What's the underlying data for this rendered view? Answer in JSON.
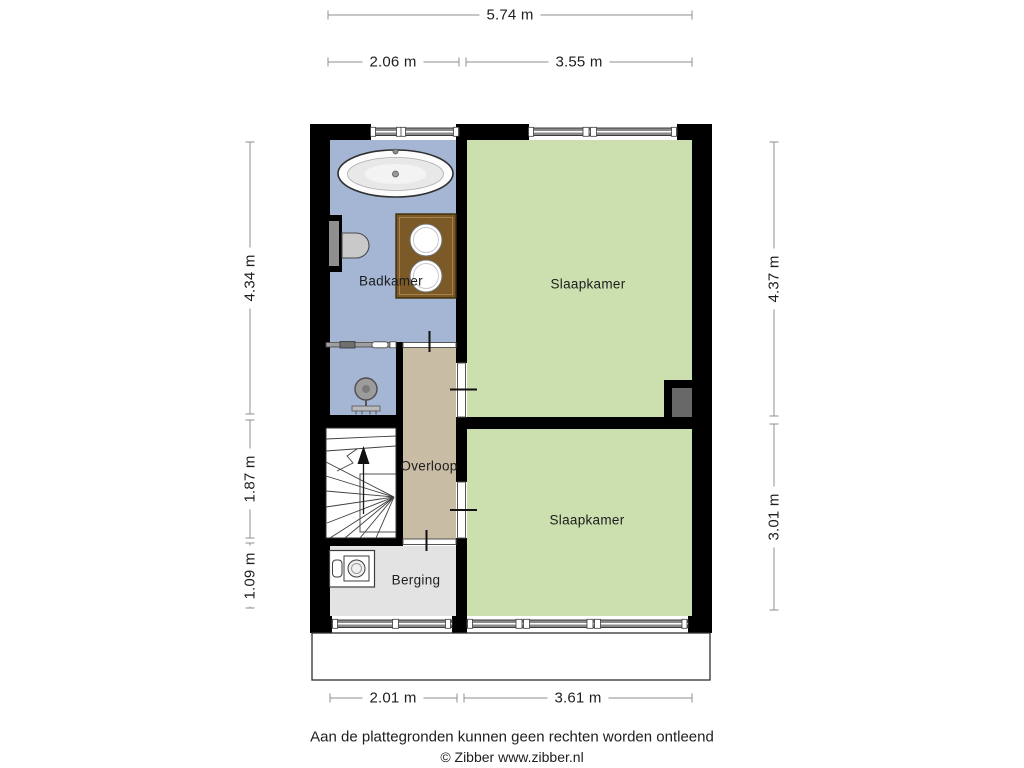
{
  "page": {
    "width": 1024,
    "height": 768,
    "background": "#ffffff"
  },
  "floorplan": {
    "rooms": [
      {
        "id": "badkamer",
        "label": "Badkamer",
        "color": "#a4b6d3"
      },
      {
        "id": "slaapkamer-top",
        "label": "Slaapkamer",
        "color": "#cbe0ae"
      },
      {
        "id": "overloop",
        "label": "Overloop",
        "color": "#c8bca4"
      },
      {
        "id": "slaapkamer-bottom",
        "label": "Slaapkamer",
        "color": "#cbe0ae"
      },
      {
        "id": "berging",
        "label": "Berging",
        "color": "#e3e3e3"
      }
    ],
    "fixtures": [
      "bathtub",
      "toilet",
      "double-sink-vanity",
      "shower",
      "staircase",
      "washing-machine",
      "shaft",
      "washing-machine"
    ],
    "dimensions": {
      "top_total": "5.74 m",
      "top_left": "2.06 m",
      "top_right": "3.55 m",
      "left_upper": "4.34 m",
      "left_middle": "1.87 m",
      "left_lower": "1.09 m",
      "right_upper": "4.37 m",
      "right_lower": "3.01 m",
      "bottom_left": "2.01 m",
      "bottom_right": "3.61 m"
    },
    "colors": {
      "wall": "#000000",
      "window_bar": "#8a8a8a",
      "shaft": "#686868",
      "vanity_wood": "#7b5a28",
      "stairs": "#ffffff",
      "dimension_line": "#8f8f8f"
    }
  },
  "footer": {
    "disclaimer": "Aan de plattegronden kunnen geen rechten worden ontleend",
    "copyright": "© Zibber www.zibber.nl"
  }
}
